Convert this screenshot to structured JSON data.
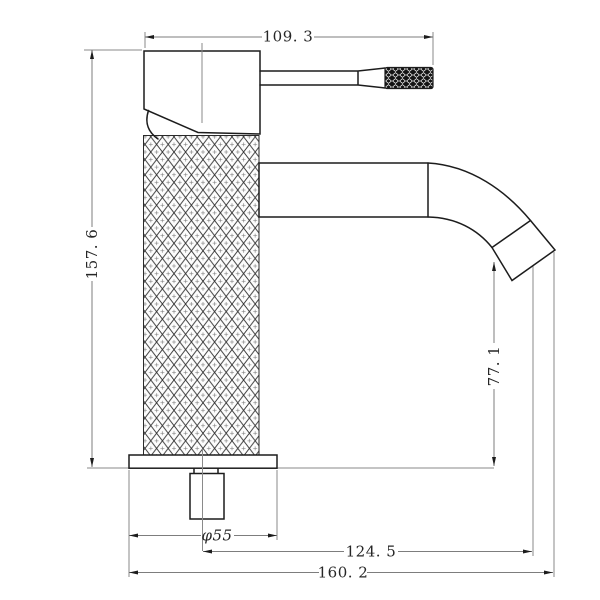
{
  "drawing": {
    "background_color": "#ffffff",
    "outline_color": "#1c1c1c",
    "dimension_line_color": "#7d7d7d",
    "text_color": "#262626",
    "dimensions": {
      "top_width": {
        "label": "109. 3",
        "value_mm": 109.3
      },
      "left_height": {
        "label": "157. 6",
        "value_mm": 157.6
      },
      "spout_height": {
        "label": "77. 1",
        "value_mm": 77.1
      },
      "base_diameter": {
        "label": "φ55",
        "value_mm": 55
      },
      "center_to_spout_tip": {
        "label": "124. 5",
        "value_mm": 124.5
      },
      "overall_depth": {
        "label": "160. 2",
        "value_mm": 160.2
      }
    }
  }
}
